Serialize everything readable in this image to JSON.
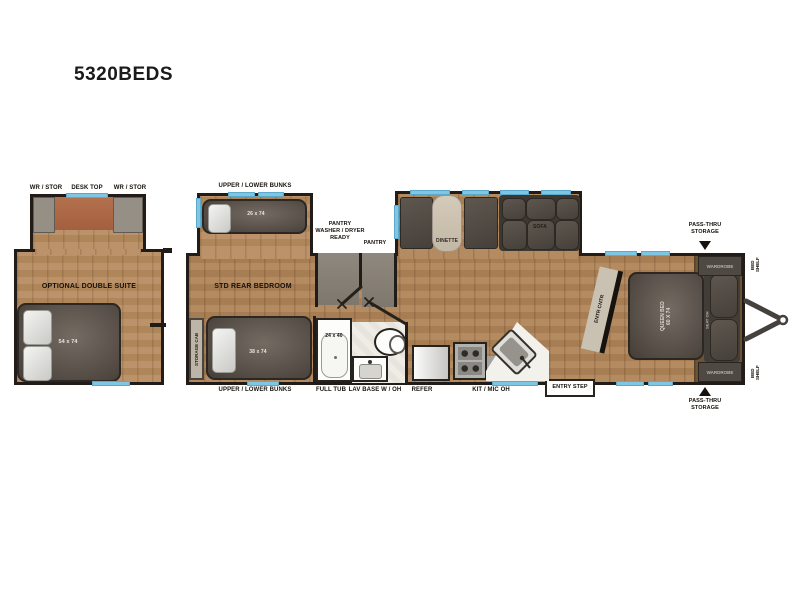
{
  "title": "5320BEDS",
  "colors": {
    "wall": "#211c17",
    "window_blue": "#7fc6e4",
    "wood_floor": "#b08457",
    "wood_floor_front": "#6d5335",
    "furniture_gray": "#5e564e",
    "desk_terracotta": "#b06b49",
    "label_text": "#17120d"
  },
  "left_suite": {
    "wr_stor_left": "WR / STOR",
    "desk_top": "DESK TOP",
    "wr_stor_right": "WR / STOR",
    "name": "OPTIONAL DOUBLE SUITE",
    "bed_size": "54 x 74"
  },
  "bunk_slide": {
    "label": "UPPER / LOWER BUNKS",
    "bed_size": "26 x 74"
  },
  "pantry": {
    "washer_dryer": "PANTRY\nWASHER / DRYER\nREADY",
    "pantry": "PANTRY"
  },
  "rear_bedroom": {
    "name": "STD REAR BEDROOM",
    "storage_cab": "STORAGE CAB",
    "bed_size": "38 x 74",
    "bunks": "UPPER / LOWER BUNKS"
  },
  "bath": {
    "full_tub": "FULL TUB",
    "tub_size": "24 x 40",
    "lav_base": "LAV BASE W / OH"
  },
  "kitchen": {
    "refer": "REFER",
    "kit_mic": "KIT / MIC OH",
    "entry_step": "ENTRY STEP"
  },
  "living": {
    "dinette": "DINETTE",
    "sofa": "SOFA",
    "entr_cntr": "ENTR CNTR"
  },
  "front_bedroom": {
    "queen_bed": "QUEEN BED\n60 X 74",
    "seat": "SEAT OH",
    "wardrobe_top": "WARDROBE",
    "wardrobe_bottom": "WARDROBE",
    "bed_shelf_top": "BED\nSHELF",
    "bed_shelf_bottom": "BED\nSHELF",
    "pass_thru_top": "PASS-THRU\nSTORAGE",
    "pass_thru_bottom": "PASS-THRU\nSTORAGE"
  }
}
